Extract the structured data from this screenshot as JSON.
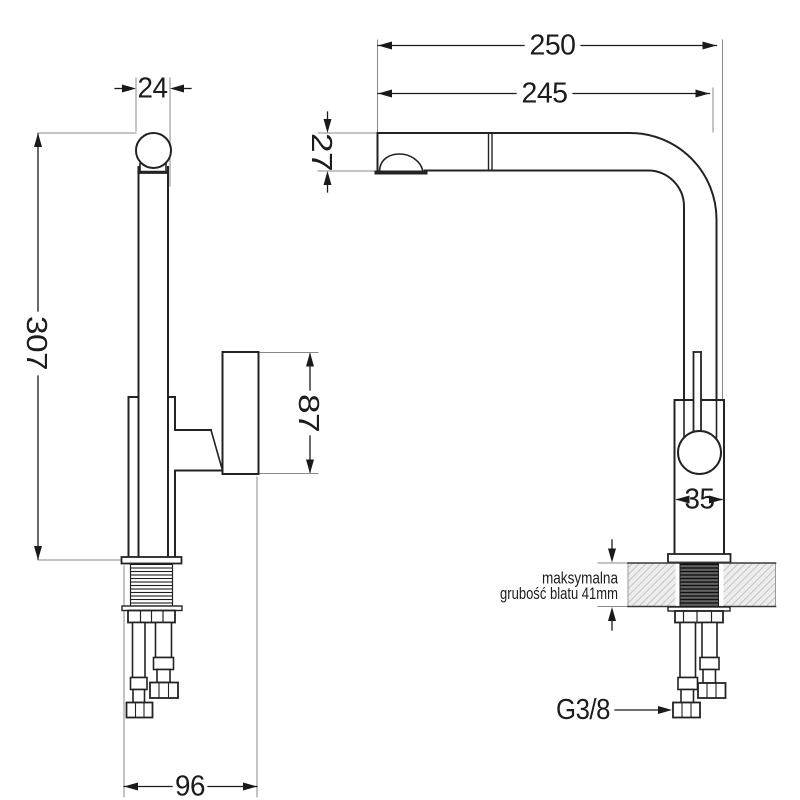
{
  "side_view": {
    "dim_spout_diameter": "24",
    "dim_total_height": "307",
    "dim_handle_height": "87",
    "dim_base_width": "96"
  },
  "front_view": {
    "dim_overall_depth": "250",
    "dim_spout_reach": "245",
    "dim_spout_height": "27",
    "dim_body_width": "35",
    "counter_note_line1": "maksymalna",
    "counter_note_line2": "grubość blatu 41mm",
    "thread_label": "G3/8"
  },
  "colors": {
    "object_line": "#232323",
    "dimension_line": "#1a1a1a",
    "extension_line": "#8a8a8a",
    "hatch": "#bfbfbf",
    "thread_dark_fill": "#646464",
    "background": "#ffffff"
  }
}
